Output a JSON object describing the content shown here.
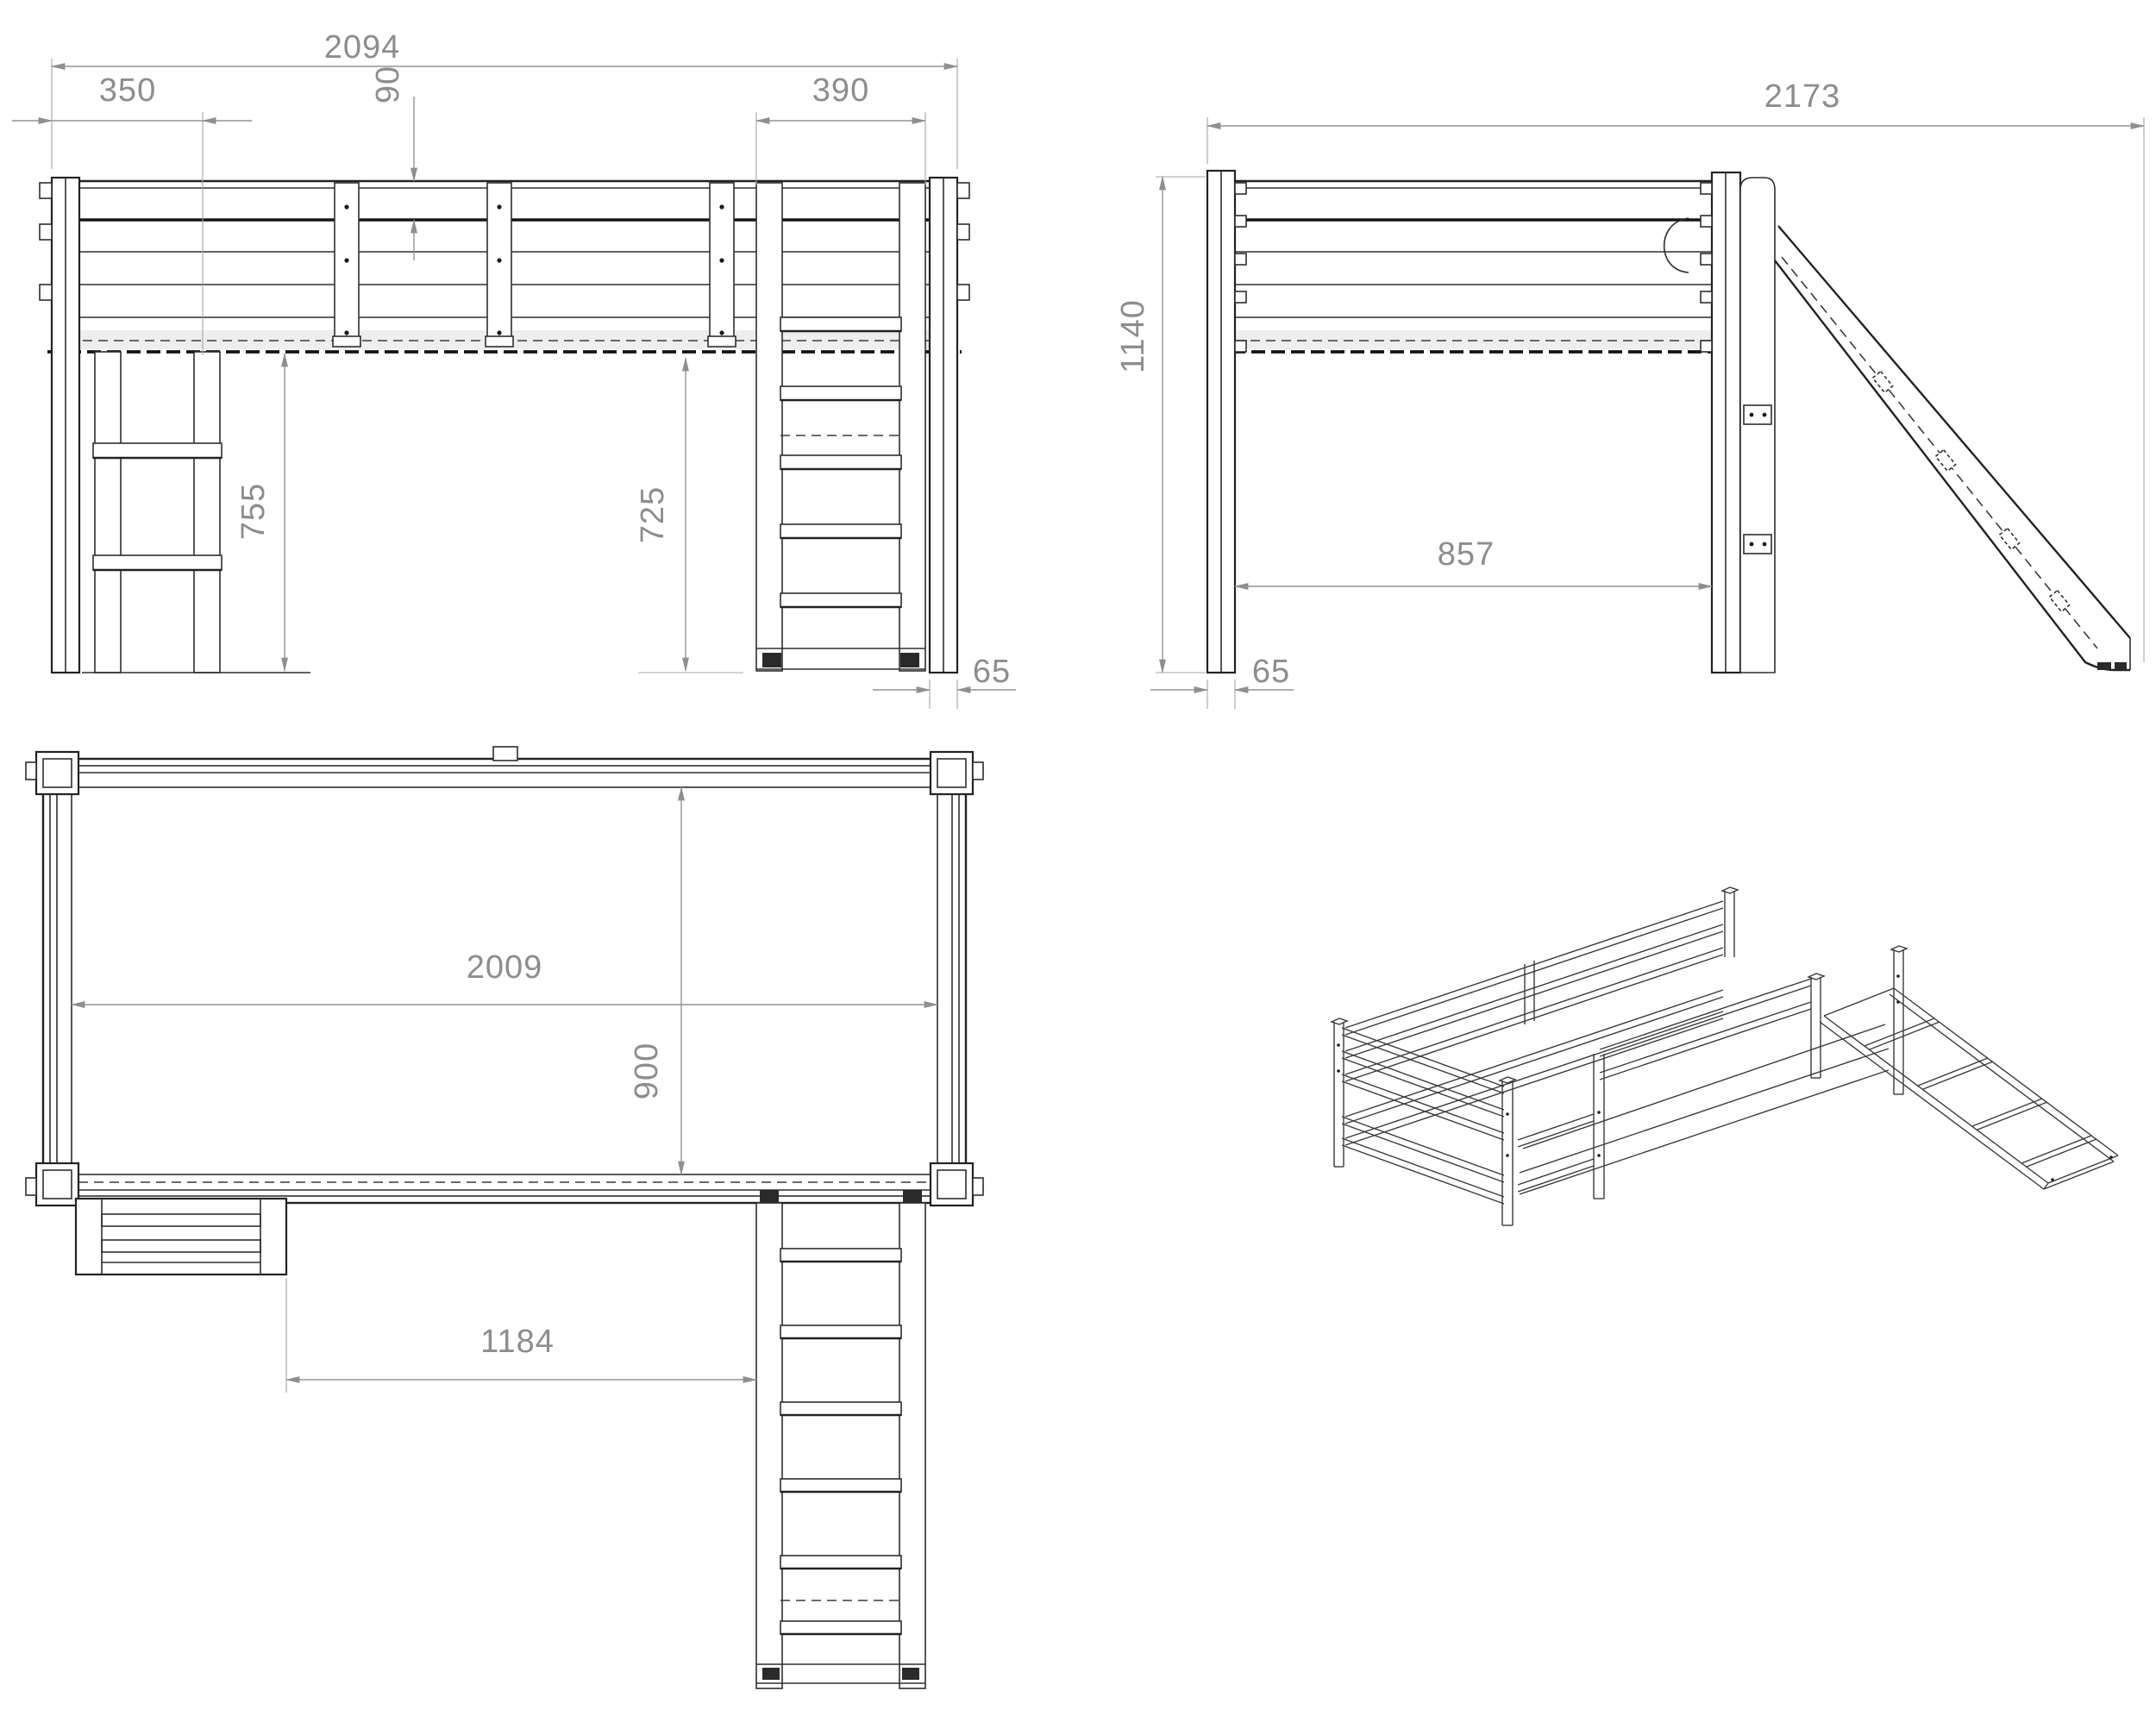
{
  "drawing": {
    "type": "furniture-technical-drawing",
    "subject": "loft bed with slide and ladder, four orthographic/axonometric views",
    "colors": {
      "line": "#2e2e2e",
      "dimension": "#8d8d8d",
      "shading_band": "#ebebeb",
      "background": "#ffffff"
    },
    "views": [
      {
        "id": "front",
        "label": "front-elevation-view"
      },
      {
        "id": "side",
        "label": "side-elevation-view"
      },
      {
        "id": "plan",
        "label": "top-plan-view"
      },
      {
        "id": "iso",
        "label": "isometric-view"
      }
    ],
    "dims": {
      "front": {
        "overall_width": "2094",
        "ladder_offset": "350",
        "rail_drop": "90",
        "slide_width": "390",
        "clearance_left": "755",
        "clearance_right": "725",
        "post_width": "65"
      },
      "side": {
        "overall_length": "2173",
        "overall_height": "1140",
        "inner_depth": "857",
        "post_width": "65"
      },
      "plan": {
        "inner_length": "2009",
        "inner_width": "900",
        "ladder_to_slide": "1184"
      }
    }
  }
}
